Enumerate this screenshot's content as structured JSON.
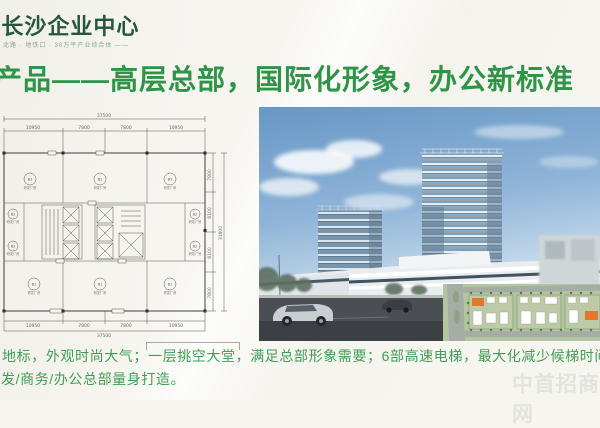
{
  "logo": {
    "title": "·长沙企业中心",
    "tagline": "北路 · 地铁口 · 30万平产业综合体 ——"
  },
  "headline": "产品——高层总部，国际化形象，办公新标准",
  "floorplan": {
    "top_total": "37500",
    "top_segs": [
      "10950",
      "7800",
      "7800",
      "10950"
    ],
    "bottom_total": "37500",
    "bottom_segs": [
      "10950",
      "7800",
      "7800",
      "10950"
    ],
    "right_segs": [
      "7800",
      "8100",
      "8100",
      "7800"
    ],
    "right_total": "31800",
    "units": [
      {
        "label": "B1",
        "caption": "研发厂房"
      },
      {
        "label": "B1",
        "caption": "研发厂房"
      },
      {
        "label": "B1",
        "caption": "研发厂房"
      },
      {
        "label": "B2",
        "caption": "研发厂房"
      },
      {
        "label": "B2",
        "caption": "研发厂房"
      },
      {
        "label": "B2",
        "caption": "研发厂房"
      },
      {
        "label": "B2",
        "caption": "研发厂房"
      },
      {
        "label": "B1",
        "caption": "研发厂房"
      },
      {
        "label": "B1",
        "caption": "研发厂房"
      },
      {
        "label": "B1",
        "caption": "研发厂房"
      }
    ]
  },
  "body_text": {
    "line1": "地标，外观时尚大气；一层挑空大堂，满足总部形象需要；6部高速电梯，最大化减少候梯时间；平面",
    "line2": "发/商务/办公总部量身打造。"
  },
  "watermark": "中首招商网",
  "colors": {
    "headline_green": "#2e9447",
    "logo_green": "#24573b",
    "body_green": "#3f9f55",
    "sky_blue": "#6e9cc9",
    "siteplan_green": "#b4c6a0",
    "accent_orange": "#e4782a"
  }
}
